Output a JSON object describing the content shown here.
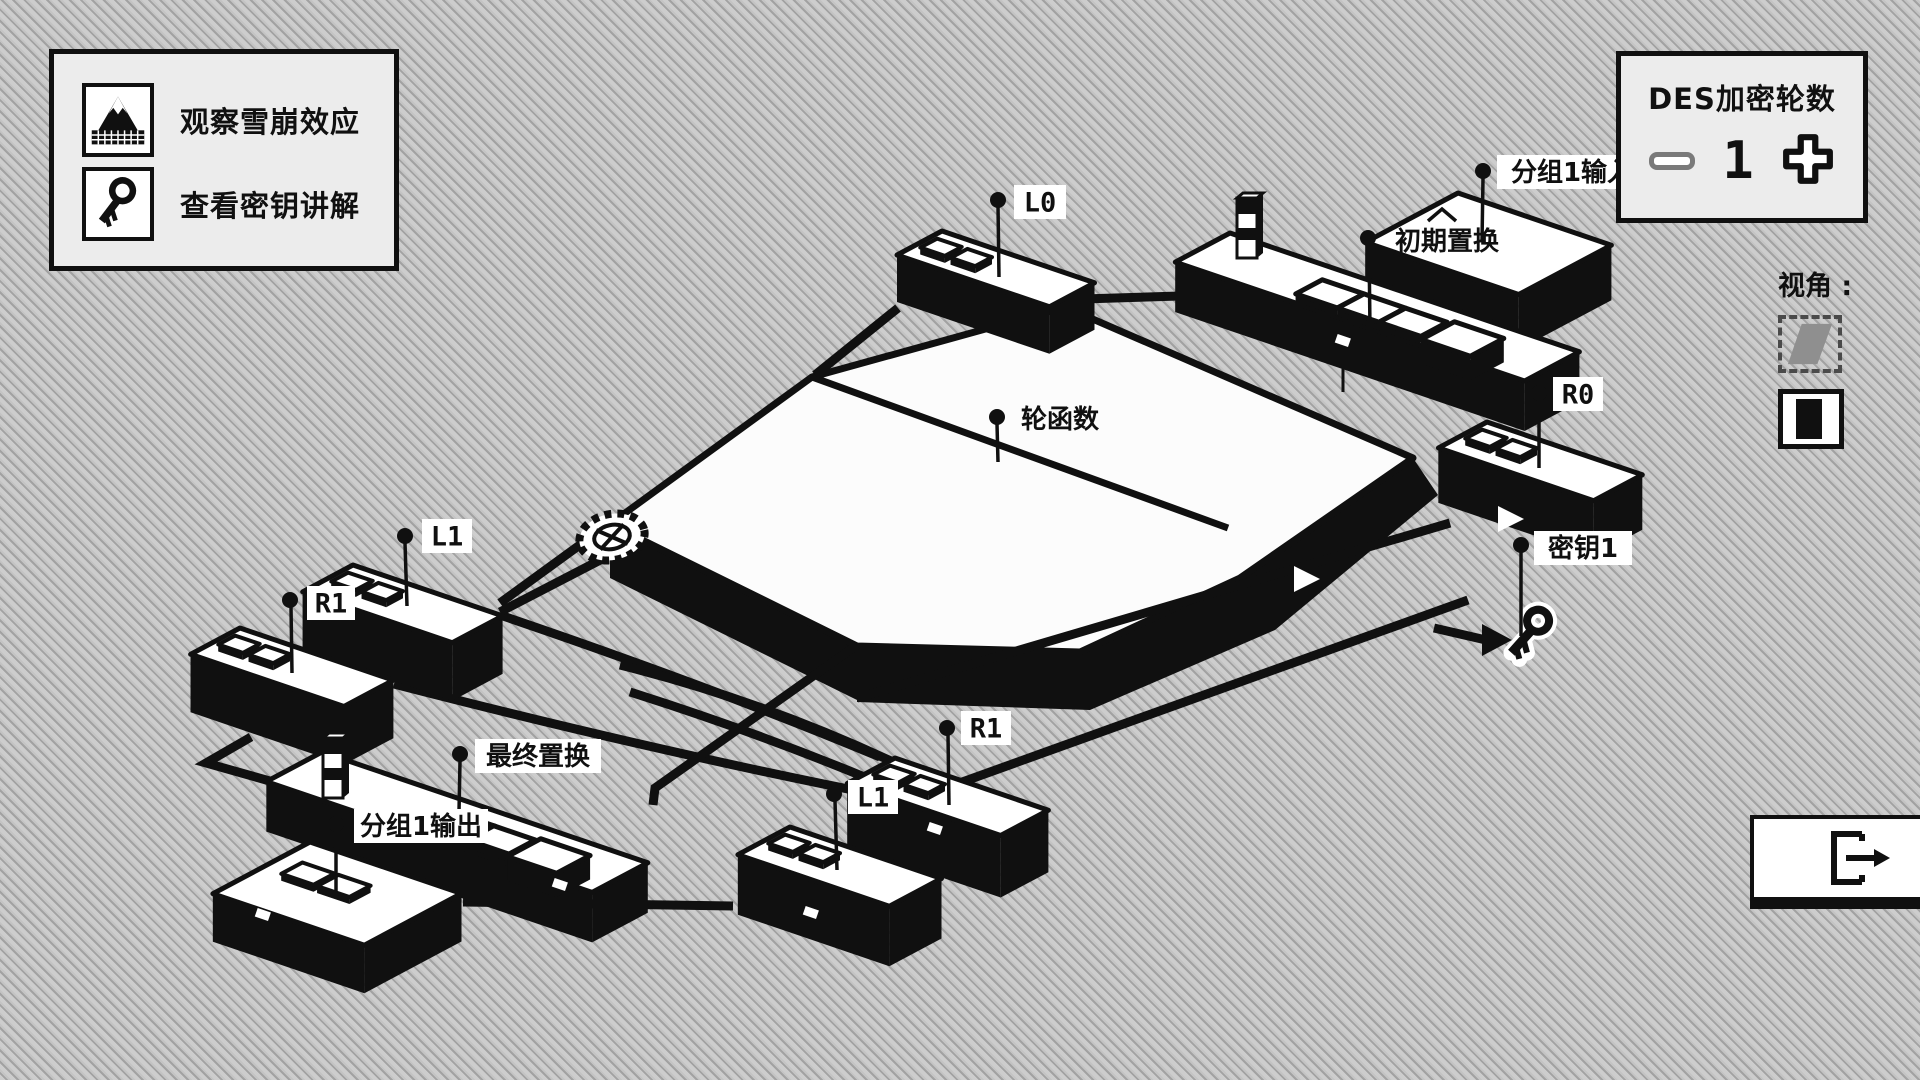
{
  "colors": {
    "background": "#c8c8c8",
    "hatch": "#a2a2a2",
    "ink": "#101010",
    "panel_bg": "#ececec",
    "block_top": "#ffffff",
    "disabled_gray": "#7a7a7a",
    "view_icon_gray": "#8f8f8f"
  },
  "menu_panel": {
    "items": [
      {
        "icon": "mountain-icon",
        "label": "观察雪崩效应"
      },
      {
        "icon": "key-icon",
        "label": "查看密钥讲解"
      }
    ]
  },
  "rounds_panel": {
    "title": "DES加密轮数",
    "value": "1",
    "minus_icon": "minus-icon",
    "plus_icon": "plus-icon"
  },
  "view_panel": {
    "label": "视角 :",
    "options": [
      "isometric-view",
      "front-view"
    ]
  },
  "exit_button": {
    "icon": "exit-icon"
  },
  "scene": {
    "labels": {
      "l0": "L0",
      "r0": "R0",
      "l1_left": "L1",
      "r1_left": "R1",
      "r1_bottom": "R1",
      "l1_bottom": "L1",
      "round_function": "轮函数",
      "initial_permutation": "初期置换",
      "final_permutation": "最终置换",
      "block1_input": "分组1输入",
      "block1_output": "分组1输出",
      "key1": "密钥1"
    }
  }
}
